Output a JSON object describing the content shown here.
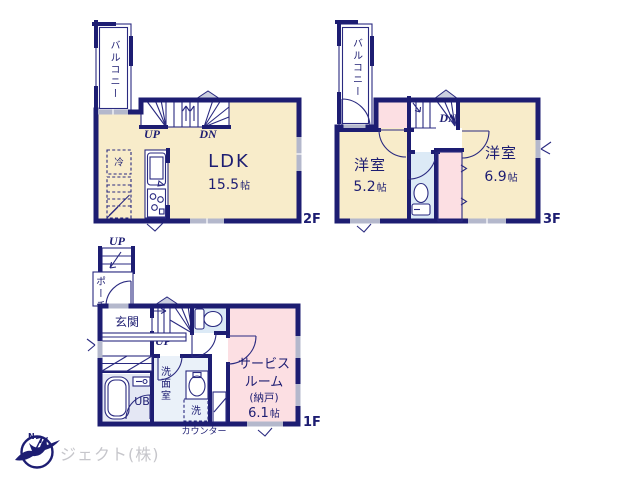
{
  "colors": {
    "bg": "#ffffff",
    "wall": "#1d1d72",
    "line": "#2a2a80",
    "room-cream": "#f8ecca",
    "room-pink": "#fcdfe3",
    "room-blue": "#dceaf6",
    "room-lavender": "#e4e7f4",
    "room-washroom": "#eaf1f9",
    "window-gray": "#b4b8cc",
    "triangle-gray": "#ccd0e0",
    "logo-gray": "#c6c6cb"
  },
  "floors": {
    "f2": {
      "floor_label": "2F",
      "balcony": "バルコニー",
      "room_name": "LDK",
      "room_size_num": "15.5",
      "room_size_unit": "帖",
      "fridge": "冷",
      "stairs_up": "UP",
      "stairs_down": "DN"
    },
    "f3": {
      "floor_label": "3F",
      "balcony": "バルコニー",
      "room1_name": "洋室",
      "room1_size_num": "5.2",
      "room1_size_unit": "帖",
      "room2_name": "洋室",
      "room2_size_num": "6.9",
      "room2_size_unit": "帖",
      "stairs_down": "DN"
    },
    "f1": {
      "floor_label": "1F",
      "outside_steps": "UP",
      "porch": "ポーチ",
      "entrance": "玄関",
      "stairs_up": "UP",
      "bath": "UB",
      "washroom": "洗面室",
      "laundry": "洗",
      "service_room_line1": "サービス",
      "service_room_line2": "ルーム",
      "service_room_line3": "(納戸)",
      "service_size_num": "6.1",
      "service_size_unit": "帖",
      "counter": "カウンター"
    }
  },
  "logo": {
    "company": "ジェクト(株)",
    "north": "N"
  }
}
